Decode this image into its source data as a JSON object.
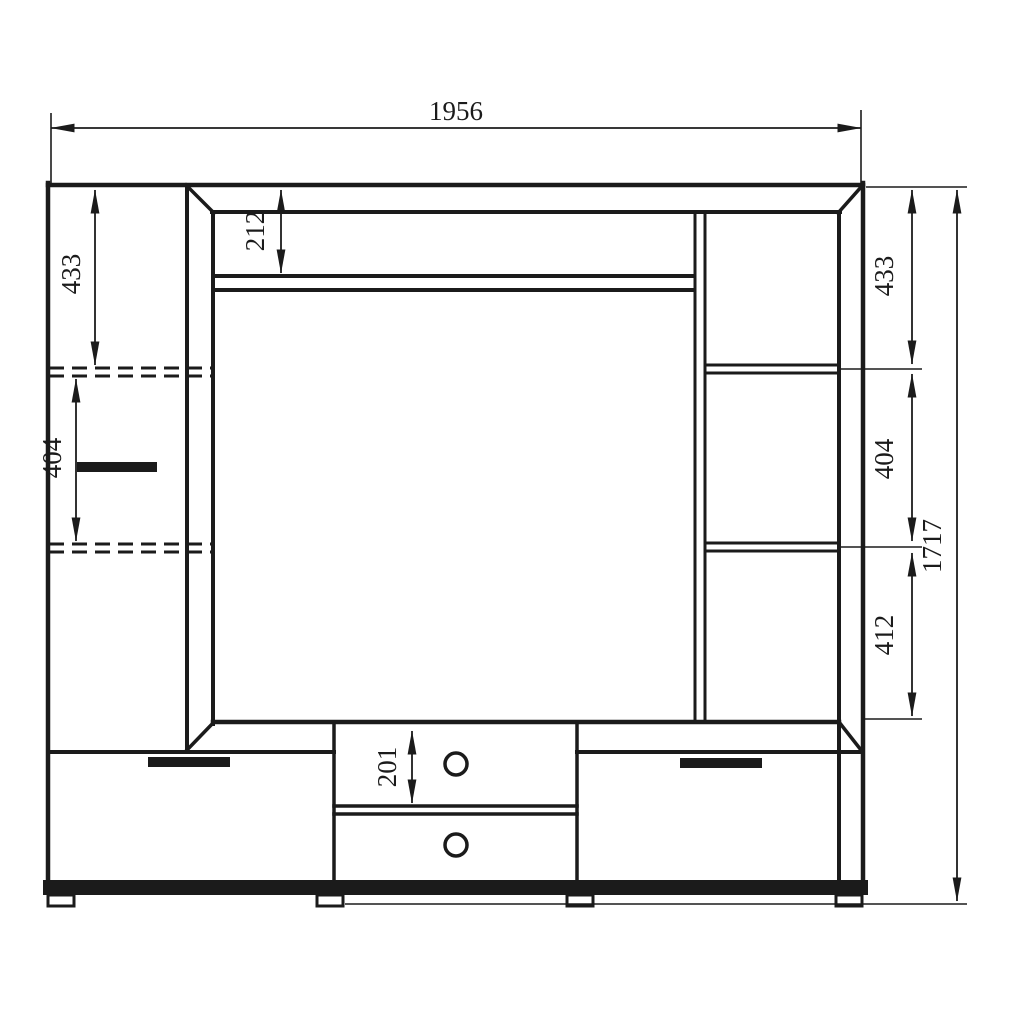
{
  "drawing": {
    "background": "#ffffff",
    "ink": "#1b1b1b",
    "dims": {
      "overall_width": "1956",
      "overall_height": "1717",
      "left_column_top_section": "433",
      "left_column_middle_section": "404",
      "top_niche_height": "212",
      "right_column_top_section": "433",
      "right_column_middle_section": "404",
      "right_column_bottom_section": "412",
      "drawer_front_height": "201"
    }
  }
}
